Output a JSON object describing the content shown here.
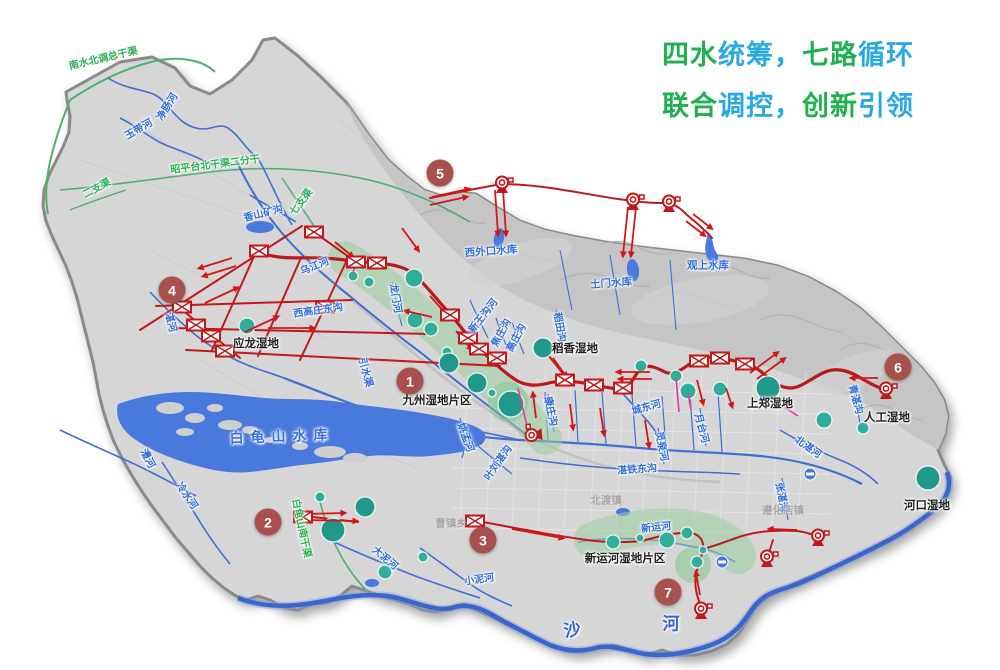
{
  "title": {
    "line1": [
      {
        "t": "四水",
        "c": "green"
      },
      {
        "t": "统筹，",
        "c": "cyan"
      },
      {
        "t": "七路",
        "c": "green"
      },
      {
        "t": "循环",
        "c": "cyan"
      }
    ],
    "line2": [
      {
        "t": "联合",
        "c": "green"
      },
      {
        "t": "调控，",
        "c": "cyan"
      },
      {
        "t": "创新",
        "c": "green"
      },
      {
        "t": "引领",
        "c": "cyan"
      }
    ]
  },
  "palette": {
    "land": "#d6d6d6",
    "mountain": "#c5c5c5",
    "water": "#4a79dd",
    "river": "#3f6fd2",
    "deep_river": "#2b55bb",
    "route_red": "#c1181b",
    "arrow_red": "#d31616",
    "magenta": "#e5399e",
    "wetland_zone": "#9bd0a2",
    "wetland_circle": "#2fae9c",
    "wetland_circle_dark": "#21998a",
    "badge": "#a8504e",
    "title_green": "#1fb150",
    "title_cyan": "#29a9e1",
    "label_blue": "#2e6ddd",
    "label_green": "#2cb054",
    "label_gray": "#a7a7a7"
  },
  "routes": [
    {
      "n": "1",
      "x": 410,
      "y": 381
    },
    {
      "n": "2",
      "x": 268,
      "y": 522
    },
    {
      "n": "3",
      "x": 483,
      "y": 540
    },
    {
      "n": "4",
      "x": 172,
      "y": 290
    },
    {
      "n": "5",
      "x": 440,
      "y": 173
    },
    {
      "n": "6",
      "x": 898,
      "y": 367
    },
    {
      "n": "7",
      "x": 668,
      "y": 592
    }
  ],
  "labels": [
    {
      "t": "南水北调总干渠",
      "x": 103,
      "y": 57,
      "r": -13,
      "c": "canal"
    },
    {
      "t": "昭平台北干渠二分干",
      "x": 215,
      "y": 163,
      "r": -7,
      "c": "canal"
    },
    {
      "t": "二支渠",
      "x": 96,
      "y": 187,
      "r": -28,
      "c": "canal"
    },
    {
      "t": "七支渠",
      "x": 300,
      "y": 201,
      "r": -52,
      "c": "canal"
    },
    {
      "t": "白龟山南干渠",
      "x": 303,
      "y": 528,
      "r": 78,
      "c": "canal"
    },
    {
      "t": "净肠河",
      "x": 166,
      "y": 106,
      "r": -58,
      "c": "river"
    },
    {
      "t": "玉带河",
      "x": 138,
      "y": 128,
      "r": -30,
      "c": "river"
    },
    {
      "t": "香山矿沟",
      "x": 263,
      "y": 212,
      "r": -14,
      "c": "river"
    },
    {
      "t": "乌江河",
      "x": 314,
      "y": 265,
      "r": -22,
      "c": "river"
    },
    {
      "t": "湛河",
      "x": 172,
      "y": 322,
      "r": 75,
      "c": "river"
    },
    {
      "t": "西高庄东沟",
      "x": 318,
      "y": 309,
      "r": -8,
      "c": "river"
    },
    {
      "t": "龙门河",
      "x": 397,
      "y": 298,
      "r": 80,
      "c": "river"
    },
    {
      "t": "新王沟河",
      "x": 482,
      "y": 315,
      "r": -52,
      "c": "river"
    },
    {
      "t": "焦庄沟",
      "x": 500,
      "y": 332,
      "r": -62,
      "c": "river"
    },
    {
      "t": "高庄沟",
      "x": 515,
      "y": 337,
      "r": -62,
      "c": "river"
    },
    {
      "t": "稻田沟",
      "x": 561,
      "y": 327,
      "r": 80,
      "c": "river"
    },
    {
      "t": "引水渠",
      "x": 367,
      "y": 372,
      "r": 75,
      "c": "river"
    },
    {
      "t": "姚孟河",
      "x": 467,
      "y": 437,
      "r": 70,
      "c": "river"
    },
    {
      "t": "叶刘湛沟",
      "x": 497,
      "y": 462,
      "r": -55,
      "c": "river"
    },
    {
      "t": "康庄沟",
      "x": 552,
      "y": 411,
      "r": 78,
      "c": "river"
    },
    {
      "t": "城东河",
      "x": 646,
      "y": 406,
      "r": -16,
      "c": "river"
    },
    {
      "t": "灵泉河",
      "x": 663,
      "y": 446,
      "r": 78,
      "c": "river"
    },
    {
      "t": "月台河",
      "x": 703,
      "y": 428,
      "r": 75,
      "c": "river"
    },
    {
      "t": "湛铁东沟",
      "x": 637,
      "y": 468,
      "r": -4,
      "c": "river"
    },
    {
      "t": "新运河",
      "x": 656,
      "y": 526,
      "r": -6,
      "c": "river"
    },
    {
      "t": "小泥河",
      "x": 479,
      "y": 578,
      "r": -8,
      "c": "river"
    },
    {
      "t": "澧河",
      "x": 149,
      "y": 458,
      "r": 62,
      "c": "river"
    },
    {
      "t": "冷水河",
      "x": 188,
      "y": 495,
      "r": 55,
      "c": "river"
    },
    {
      "t": "大泥河",
      "x": 386,
      "y": 557,
      "r": 40,
      "c": "river"
    },
    {
      "t": "北湛河",
      "x": 809,
      "y": 446,
      "r": 35,
      "c": "river"
    },
    {
      "t": "青湛沟",
      "x": 857,
      "y": 399,
      "r": 75,
      "c": "river"
    },
    {
      "t": "张湛沟",
      "x": 783,
      "y": 497,
      "r": 80,
      "c": "river"
    },
    {
      "t": "沙",
      "x": 573,
      "y": 628,
      "r": -10,
      "c": "bigriver"
    },
    {
      "t": "河",
      "x": 672,
      "y": 622,
      "r": 0,
      "c": "bigriver"
    },
    {
      "t": "白龟山水库",
      "x": 282,
      "y": 436,
      "r": -2,
      "c": "lakename"
    },
    {
      "t": "西外口水库",
      "x": 491,
      "y": 251,
      "r": -4,
      "c": "res"
    },
    {
      "t": "土门水库",
      "x": 611,
      "y": 283,
      "r": -4,
      "c": "res"
    },
    {
      "t": "观上水库",
      "x": 708,
      "y": 265,
      "r": 0,
      "c": "res"
    },
    {
      "t": "应龙湿地",
      "x": 256,
      "y": 343,
      "r": 0,
      "c": "wet"
    },
    {
      "t": "九州湿地片区",
      "x": 437,
      "y": 400,
      "r": 0,
      "c": "wet"
    },
    {
      "t": "稻香湿地",
      "x": 575,
      "y": 348,
      "r": 0,
      "c": "wet"
    },
    {
      "t": "上郑湿地",
      "x": 770,
      "y": 403,
      "r": 0,
      "c": "wet"
    },
    {
      "t": "人工湿地",
      "x": 887,
      "y": 417,
      "r": 0,
      "c": "wet"
    },
    {
      "t": "河口湿地",
      "x": 927,
      "y": 505,
      "r": 0,
      "c": "wet"
    },
    {
      "t": "新运河湿地片区",
      "x": 625,
      "y": 558,
      "r": 0,
      "c": "wet"
    },
    {
      "t": "北渡镇",
      "x": 606,
      "y": 500,
      "r": 0,
      "c": "town"
    },
    {
      "t": "曹镇乡",
      "x": 451,
      "y": 523,
      "r": 0,
      "c": "town"
    },
    {
      "t": "遵化店镇",
      "x": 783,
      "y": 510,
      "r": 0,
      "c": "town"
    }
  ],
  "wetland_circles": [
    [
      247,
      326,
      8
    ],
    [
      353,
      276,
      5
    ],
    [
      369,
      282,
      5
    ],
    [
      414,
      278,
      9
    ],
    [
      415,
      320,
      8
    ],
    [
      431,
      329,
      7
    ],
    [
      447,
      352,
      5
    ],
    [
      449,
      363,
      10
    ],
    [
      477,
      383,
      10
    ],
    [
      492,
      393,
      4
    ],
    [
      511,
      404,
      13
    ],
    [
      543,
      348,
      10
    ],
    [
      641,
      366,
      6
    ],
    [
      676,
      376,
      6
    ],
    [
      688,
      391,
      8
    ],
    [
      720,
      389,
      7
    ],
    [
      768,
      388,
      12
    ],
    [
      824,
      420,
      8
    ],
    [
      863,
      428,
      6
    ],
    [
      928,
      478,
      12
    ],
    [
      320,
      497,
      5
    ],
    [
      365,
      507,
      10
    ],
    [
      333,
      530,
      12
    ],
    [
      385,
      572,
      7
    ],
    [
      423,
      557,
      5
    ],
    [
      613,
      542,
      7
    ],
    [
      640,
      538,
      4
    ],
    [
      667,
      540,
      8
    ],
    [
      687,
      533,
      6
    ],
    [
      703,
      550,
      4
    ],
    [
      697,
      562,
      6
    ]
  ],
  "gates": [
    [
      259,
      251
    ],
    [
      314,
      232
    ],
    [
      356,
      262
    ],
    [
      377,
      263
    ],
    [
      182,
      307
    ],
    [
      196,
      325
    ],
    [
      211,
      336
    ],
    [
      225,
      351
    ],
    [
      325,
      307
    ],
    [
      450,
      315
    ],
    [
      468,
      338
    ],
    [
      479,
      349
    ],
    [
      497,
      358
    ],
    [
      565,
      380
    ],
    [
      594,
      385
    ],
    [
      623,
      388
    ],
    [
      699,
      361
    ],
    [
      720,
      358
    ],
    [
      745,
      364
    ],
    [
      303,
      517
    ],
    [
      475,
      521
    ]
  ],
  "pumps": [
    {
      "x": 502,
      "y": 184,
      "rot": 0
    },
    {
      "x": 633,
      "y": 201,
      "rot": 0
    },
    {
      "x": 669,
      "y": 203,
      "rot": 0
    },
    {
      "x": 533,
      "y": 435,
      "rot": -95
    },
    {
      "x": 886,
      "y": 390,
      "rot": 0
    },
    {
      "x": 818,
      "y": 537,
      "rot": 0
    },
    {
      "x": 767,
      "y": 558,
      "rot": 0
    },
    {
      "x": 701,
      "y": 610,
      "rot": 0
    }
  ],
  "weirs": [
    [
      810,
      474
    ],
    [
      722,
      562
    ]
  ],
  "arrows": [
    [
      432,
      197,
      468,
      189
    ],
    [
      430,
      205,
      466,
      197
    ],
    [
      495,
      190,
      498,
      234
    ],
    [
      503,
      190,
      506,
      234
    ],
    [
      628,
      207,
      623,
      255
    ],
    [
      636,
      207,
      631,
      255
    ],
    [
      686,
      221,
      704,
      235
    ],
    [
      693,
      214,
      711,
      228
    ],
    [
      232,
      258,
      200,
      268
    ],
    [
      236,
      266,
      204,
      276
    ],
    [
      205,
      303,
      237,
      288
    ],
    [
      245,
      332,
      277,
      317
    ],
    [
      268,
      328,
      313,
      328
    ],
    [
      335,
      242,
      352,
      256
    ],
    [
      432,
      317,
      406,
      311
    ],
    [
      402,
      228,
      418,
      250
    ],
    [
      430,
      296,
      446,
      314
    ],
    [
      456,
      331,
      471,
      349
    ],
    [
      650,
      372,
      618,
      372
    ],
    [
      652,
      379,
      620,
      379
    ],
    [
      553,
      358,
      566,
      376
    ],
    [
      570,
      404,
      573,
      428
    ],
    [
      600,
      408,
      604,
      434
    ],
    [
      645,
      420,
      649,
      446
    ],
    [
      536,
      418,
      533,
      394
    ],
    [
      697,
      380,
      703,
      403
    ],
    [
      726,
      388,
      732,
      406
    ],
    [
      750,
      373,
      777,
      353
    ],
    [
      757,
      379,
      784,
      359
    ],
    [
      878,
      378,
      852,
      378
    ],
    [
      305,
      514,
      344,
      513
    ],
    [
      305,
      520,
      356,
      521
    ],
    [
      512,
      529,
      562,
      538
    ],
    [
      700,
      595,
      696,
      573
    ],
    [
      797,
      530,
      770,
      529
    ]
  ],
  "magenta_links": [
    [
      528,
      430,
      518,
      388
    ],
    [
      676,
      378,
      679,
      412
    ],
    [
      688,
      393,
      691,
      410
    ],
    [
      770,
      398,
      798,
      416
    ],
    [
      196,
      323,
      204,
      334
    ],
    [
      355,
      265,
      353,
      273
    ]
  ]
}
